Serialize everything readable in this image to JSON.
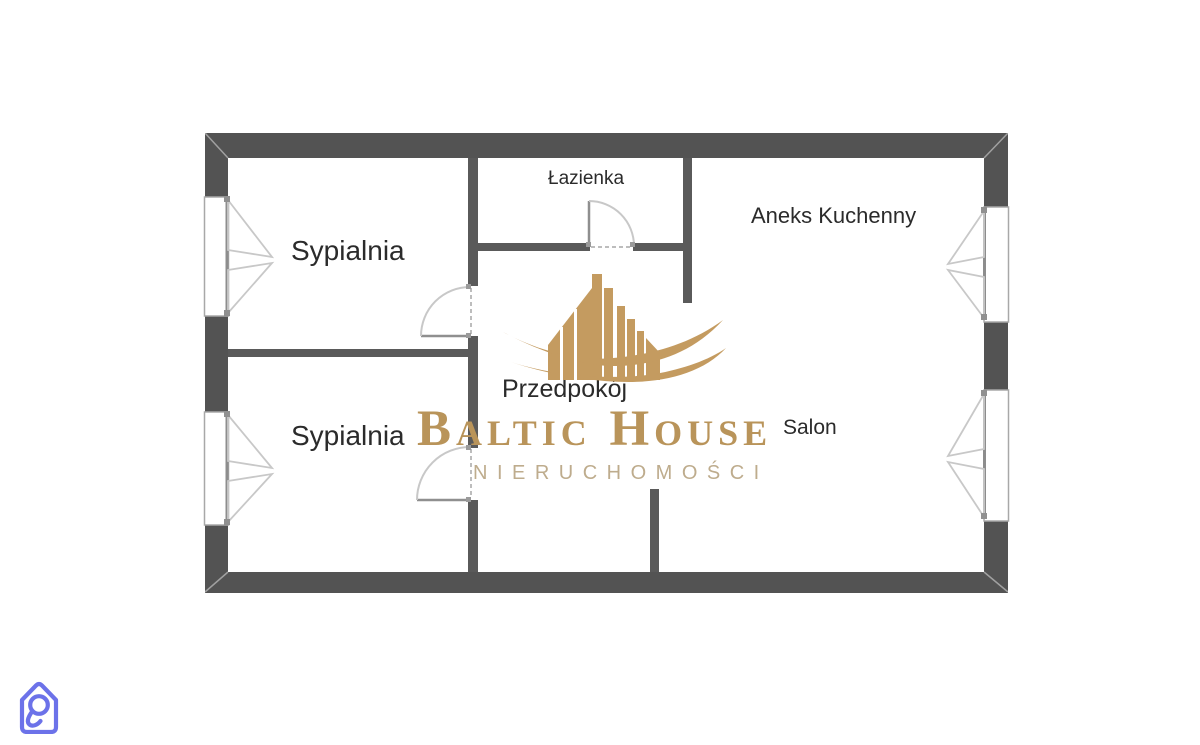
{
  "plan": {
    "rooms": [
      {
        "name": "sypialnia-top",
        "label": "Sypialnia"
      },
      {
        "name": "lazienka",
        "label": "Łazienka"
      },
      {
        "name": "aneks-kuchenny",
        "label": "Aneks Kuchenny"
      },
      {
        "name": "sypialnia-bottom",
        "label": "Sypialnia"
      },
      {
        "name": "przedpokoj",
        "label": "Przedpokój"
      },
      {
        "name": "salon",
        "label": "Salon"
      }
    ]
  },
  "watermark": {
    "brand": "Baltic House",
    "subtitle": "NIERUCHOMOŚCI",
    "brand_color": "#B9945A",
    "subtitle_color": "#BEAC8D",
    "skyline_color": "#C49B60"
  },
  "corner_logo": {
    "name": "house-loop-logo",
    "color": "#6C72E9"
  },
  "colors": {
    "outer_wall": "#535353",
    "inner_wall": "#5A5A5A",
    "fixture_line": "#C8C8C8",
    "label_text": "#2B2B2B",
    "background": "#FFFFFF"
  }
}
